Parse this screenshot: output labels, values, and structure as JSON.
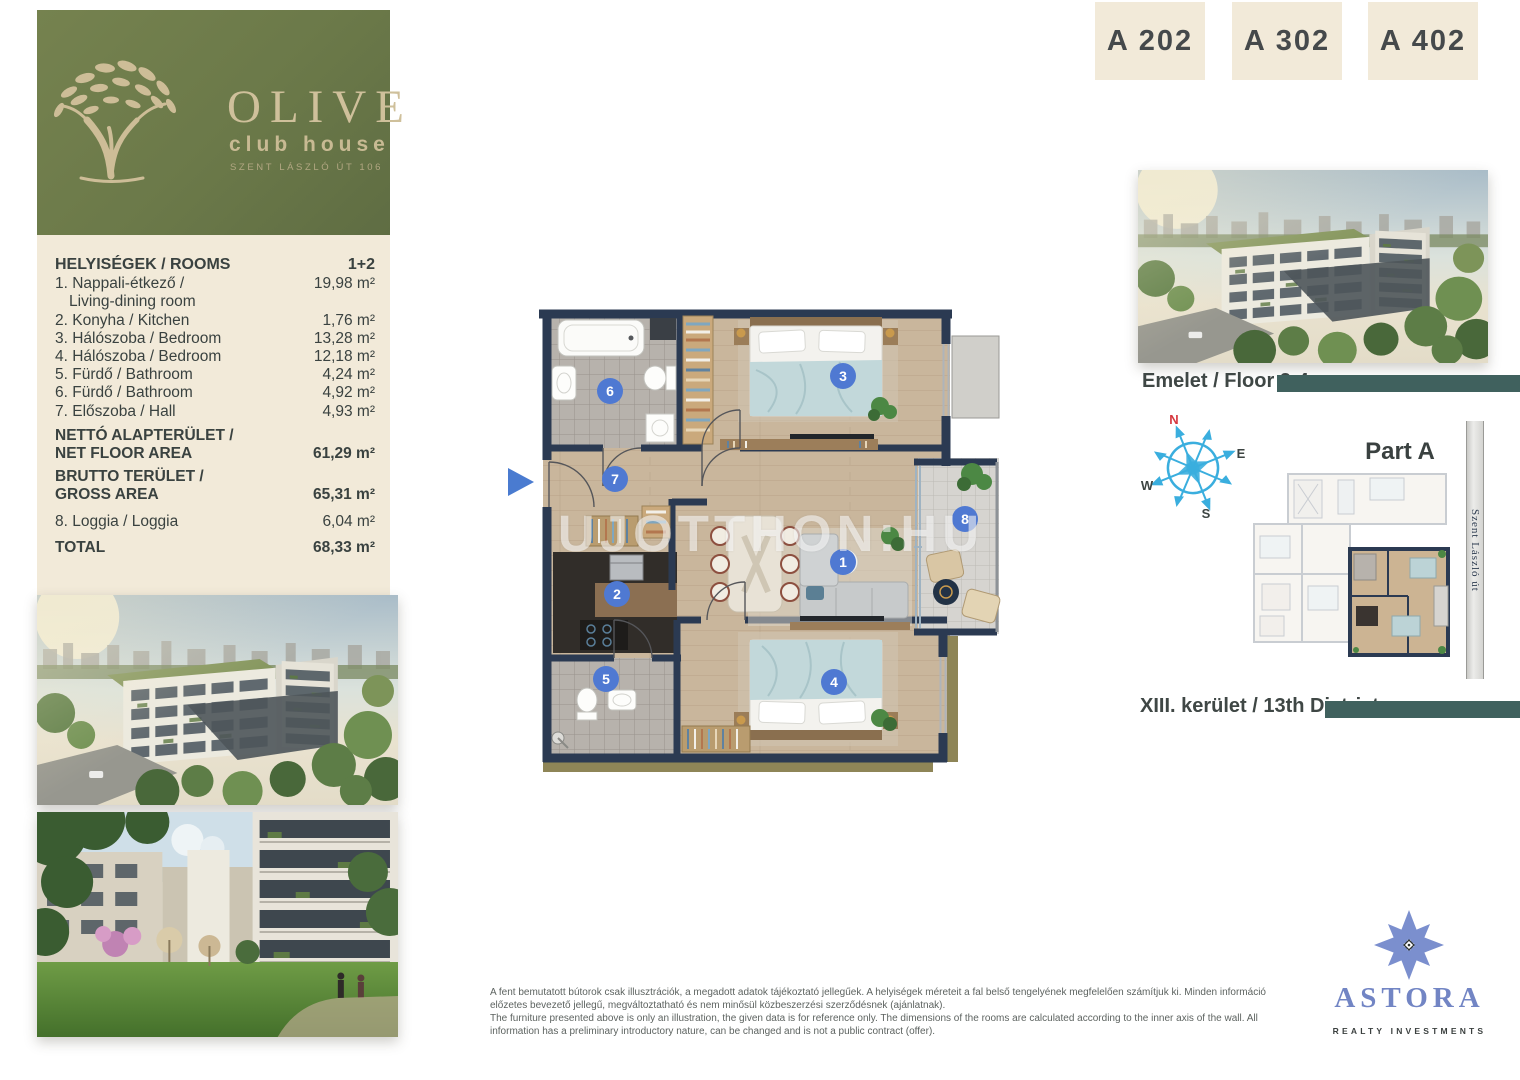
{
  "logo": {
    "title": "OLIVE",
    "subtitle": "club house",
    "address": "SZENT LÁSZLÓ ÚT 106"
  },
  "units": [
    "A 202",
    "A 302",
    "A 402"
  ],
  "room_table": {
    "header": {
      "label": "HELYISÉGEK / ROOMS",
      "value": "1+2"
    },
    "rows": [
      {
        "label": "1. Nappali-étkező /",
        "label2": "Living-dining room",
        "value": "19,98 m²"
      },
      {
        "label": "2. Konyha / Kitchen",
        "value": "1,76 m²"
      },
      {
        "label": "3. Hálószoba / Bedroom",
        "value": "13,28 m²"
      },
      {
        "label": "4. Hálószoba / Bedroom",
        "value": "12,18 m²"
      },
      {
        "label": "5. Fürdő / Bathroom",
        "value": "4,24 m²"
      },
      {
        "label": "6.  Fürdő / Bathroom",
        "value": "4,92 m²"
      },
      {
        "label": "7. Előszoba / Hall",
        "value": "4,93 m²"
      }
    ],
    "net": {
      "label": "NETTÓ ALAPTERÜLET /",
      "label2": "NET FLOOR AREA",
      "value": "61,29 m²"
    },
    "gross": {
      "label": "BRUTTO TERÜLET /",
      "label2": "GROSS AREA",
      "value": "65,31 m²"
    },
    "loggia": {
      "label": "8. Loggia / Loggia",
      "value": "6,04 m²"
    },
    "total": {
      "label": "TOTAL",
      "value": "68,33 m²"
    }
  },
  "floorplan": {
    "watermark": "UJOTTHON:HU",
    "room_numbers": [
      "1",
      "2",
      "3",
      "4",
      "5",
      "6",
      "7",
      "8"
    ]
  },
  "right_panel": {
    "floor_caption": "Emelet / Floor 2-4",
    "part_label": "Part A",
    "street": "Szent László út",
    "district_caption": "XIII. kerület / 13th District",
    "compass": {
      "n": "N",
      "e": "E",
      "s": "S",
      "w": "W"
    }
  },
  "disclaimer": {
    "hu": "A fent bemutatott bútorok csak illusztrációk, a megadott adatok tájékoztató jellegűek. A helyiségek méreteit a fal belső tengelyének megfelelően számítjuk ki. Minden információ előzetes bevezető jellegű, megváltoztatható és nem minősül közbeszerzési szerződésnek (ajánlatnak).",
    "en": "The furniture presented above is only an illustration, the given data is for reference only. The dimensions of the rooms are calculated according to the inner axis of the wall. All information has a preliminary introductory nature, can be changed and is not a public contract (offer)."
  },
  "brand": {
    "name": "ASTORA",
    "tagline": "REALTY INVESTMENTS"
  },
  "colors": {
    "accent_teal": "#40615e",
    "olive_green": "#6b7949",
    "cream": "#f2ead9",
    "navy_wall": "#2b3a52",
    "badge_blue": "#4f79d2"
  }
}
